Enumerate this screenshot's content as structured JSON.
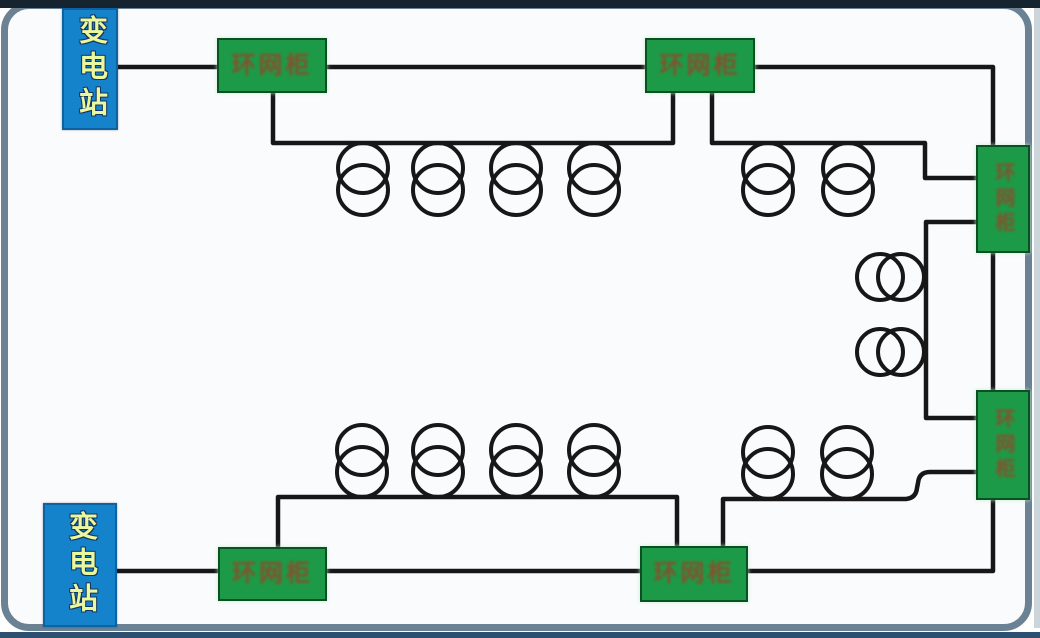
{
  "diagram": {
    "kind": "power-distribution-ring-network",
    "nodes": {
      "substation_top": {
        "label": "变电站"
      },
      "substation_bottom": {
        "label": "变电站"
      },
      "rmu_top_left": {
        "label": "环网柜"
      },
      "rmu_top_right": {
        "label": "环网柜"
      },
      "rmu_right_upper": {
        "label": "环网柜"
      },
      "rmu_right_lower": {
        "label": "环网柜"
      },
      "rmu_bottom_left": {
        "label": "环网柜"
      },
      "rmu_bottom_right": {
        "label": "环网柜"
      }
    },
    "transformers": {
      "total": 12,
      "top_left_group": 4,
      "top_right_group": 2,
      "right_middle_group": 2,
      "bottom_left_group": 4,
      "bottom_right_group": 2
    },
    "colors": {
      "frame": "#6a8294",
      "canvas": "#fafbfd",
      "edge_dark": "#15242f",
      "edge_bottom": "#2e5070",
      "wire": "#171717",
      "substation_fill": "#1583cb",
      "substation_text": "#ebf79d",
      "rmu_fill": "#1d9a47",
      "rmu_text": "#8f4a2b"
    }
  }
}
